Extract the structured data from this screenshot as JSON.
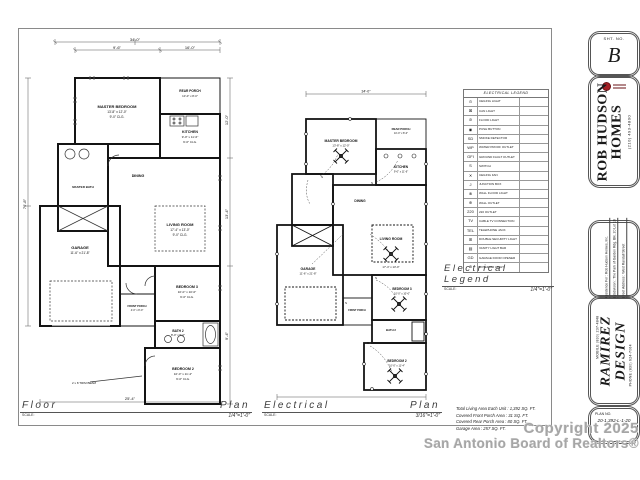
{
  "sheet": {
    "sheet_label": "SHT. NO.",
    "sheet_no": "B",
    "builder_name_line1": "ROB HUDSON",
    "builder_name_line2": "HOMES",
    "builder_phone": "(210) 493-4800",
    "project_lines": [
      "Residence For : Rob Hudson Homes, Inc.",
      "Subdivision : The Park of Garden Rdg. Blk. 20 Lot 16",
      "Street Address : West Randall Street"
    ],
    "designer_mobile": "MOBILE (830) 237-4848",
    "designer_name_line1": "RAMIREZ",
    "designer_name_line2": "DESIGN",
    "designer_phone": "PHONE (830) 624-7064",
    "plan_no_label": "PLAN NO.",
    "plan_no": "20-1,392-L-1-20"
  },
  "plans": {
    "rooms": [
      {
        "name": "MASTER BEDROOM",
        "size": "13'-8\" x 12'-0\"",
        "clg": "9'-0\" CLG."
      },
      {
        "name": "REAR PORCH",
        "size": "10'-0\" x 8'-0\"",
        "clg": "9'-0\" CLG."
      },
      {
        "name": "KITCHEN",
        "size": "9'-0\" x 11'-6\"",
        "clg": "9'-0\" CLG."
      },
      {
        "name": "DINING",
        "size": "",
        "clg": ""
      },
      {
        "name": "LIVING ROOM",
        "size": "17'-4\" x 13'-0\"",
        "clg": "9'-0\" CLG."
      },
      {
        "name": "GARAGE",
        "size": "11'-6\" x 21'-8\"",
        "clg": ""
      },
      {
        "name": "FRONT PORCH",
        "size": "4'-0\" x 8'-0\"",
        "clg": ""
      },
      {
        "name": "BEDROOM 3",
        "size": "10'-0\" x 10'-0\"",
        "clg": "9'-0\" CLG."
      },
      {
        "name": "BATH 2",
        "size": "8'-0\" x 5'-0\"",
        "clg": ""
      },
      {
        "name": "BEDROOM 2",
        "size": "10'-0\" x 11'-4\"",
        "clg": "9'-0\" CLG."
      }
    ],
    "note_trim_beam": "2 x 8 TRIM BEAM",
    "master_bath_label": "MASTER BATH"
  },
  "dims": {
    "top_overall": "34'-0\"",
    "top_a": "9'-6\"",
    "top_b": "16'-0\"",
    "left": "76'-8\"",
    "right_a": "12'-0\"",
    "right_b": "13'-4\"",
    "right_c": "9'-4\"",
    "bottom": "25'-4\""
  },
  "legend": {
    "title": "ELECTRICAL LEGEND",
    "rows": [
      {
        "sym": "⊙",
        "label": "CEILING LIGHT"
      },
      {
        "sym": "⊠",
        "label": "CAN LIGHT"
      },
      {
        "sym": "⊘",
        "label": "FLOOD LIGHT"
      },
      {
        "sym": "◉",
        "label": "PUSH BUTTON"
      },
      {
        "sym": "SD",
        "label": "SMOKE DETECTOR"
      },
      {
        "sym": "WP",
        "label": "WATER PROOF OUTLET"
      },
      {
        "sym": "GFI",
        "label": "GROUND FAULT OUTLET"
      },
      {
        "sym": "S",
        "label": "SWITCH"
      },
      {
        "sym": "✕",
        "label": "CEILING FAN"
      },
      {
        "sym": "J",
        "label": "JUNCTION BOX"
      },
      {
        "sym": "⊗",
        "label": "WALL FLOOD LIGHT"
      },
      {
        "sym": "⊕",
        "label": "WALL OUTLET"
      },
      {
        "sym": "220",
        "label": "220 OUTLET"
      },
      {
        "sym": "TV",
        "label": "CABLE TV CONNECTION"
      },
      {
        "sym": "TEL",
        "label": "TELEPHONE JACK"
      },
      {
        "sym": "⊞",
        "label": "DOUBLE SECURITY LIGHT"
      },
      {
        "sym": "▤",
        "label": "VANITY LIGHT BAR"
      },
      {
        "sym": "GD",
        "label": "GARAGE DOOR OPENER"
      },
      {
        "sym": "⊛",
        "label": "EXTERIOR LIGHT"
      }
    ]
  },
  "legend_heading": {
    "text": "Electrical  Legend",
    "scale_label": "SCALE:",
    "scale": "1/4\"=1'-0\""
  },
  "floor_heading": {
    "word1": "Floor",
    "word2": "Plan",
    "scale_label": "SCALE:",
    "scale": "1/4\"=1'-0\""
  },
  "electrical_heading": {
    "word1": "Electrical",
    "word2": "Plan",
    "scale_label": "SCALE:",
    "scale": "3/16\"=1'-0\""
  },
  "areas": {
    "line1": "Total Living Area Each Unit : 1,392 SQ. FT.",
    "line2": "Covered Front Porch Area : 31 SQ. FT.",
    "line3": "Covered Rear Porch Area : 80 SQ. FT.",
    "line4": "Garage Area : 257 SQ. FT."
  },
  "watermark": {
    "line1": "Copyright 2025",
    "line2": "San Antonio Board of Realtors®"
  }
}
